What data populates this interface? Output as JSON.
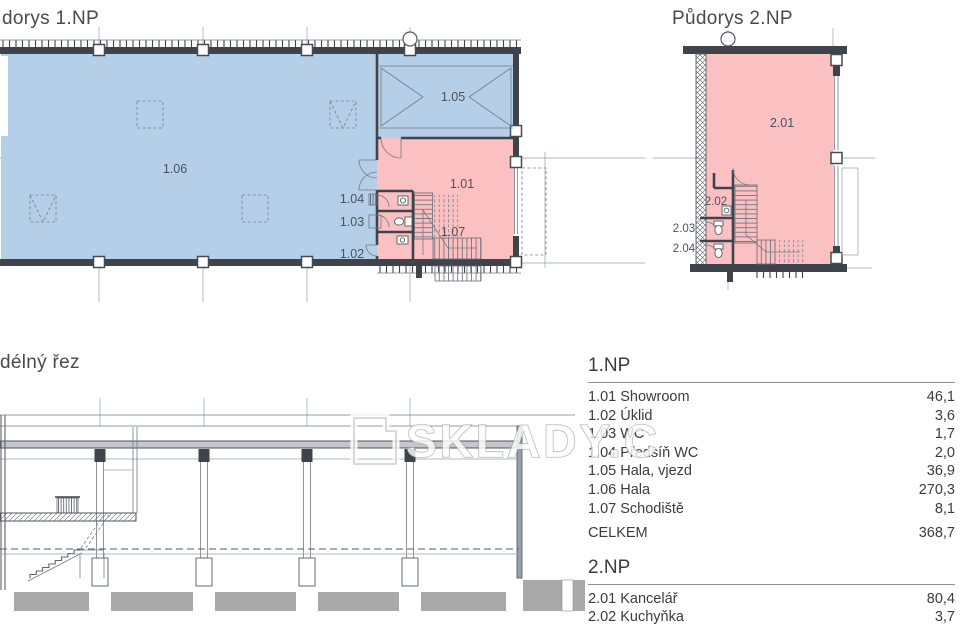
{
  "plans": {
    "plan1": {
      "title": "dorys 1.NP",
      "rooms": {
        "r101": "1.01",
        "r102": "1.02",
        "r103": "1.03",
        "r104": "1.04",
        "r105": "1.05",
        "r106": "1.06",
        "r107": "1.07"
      }
    },
    "plan2": {
      "title": "Půdorys 2.NP",
      "rooms": {
        "r201": "2.01",
        "r202": "2.02",
        "r203": "2.03",
        "r204": "2.04"
      }
    },
    "section": {
      "title": "délný řez"
    }
  },
  "watermark": {
    "text": "SKLADY.C"
  },
  "colors": {
    "hala_fill": "#b5cfe8",
    "office_fill": "#fbc0c1",
    "wall": "#3f444c"
  },
  "legend": {
    "floor1": {
      "heading": "1.NP",
      "rows": [
        {
          "label": "1.01 Showroom",
          "value": "46,1"
        },
        {
          "label": "1.02 Úklid",
          "value": "3,6"
        },
        {
          "label": "1.03 WC",
          "value": "1,7"
        },
        {
          "label": "1.04 Předsíň WC",
          "value": "2,0"
        },
        {
          "label": "1.05 Hala, vjezd",
          "value": "36,9"
        },
        {
          "label": "1.06 Hala",
          "value": "270,3"
        },
        {
          "label": "1.07 Schodiště",
          "value": "8,1"
        }
      ],
      "total_label": "CELKEM",
      "total_value": "368,7"
    },
    "floor2": {
      "heading": "2.NP",
      "rows": [
        {
          "label": "2.01 Kancelář",
          "value": "80,4"
        },
        {
          "label": "2.02 Kuchyňka",
          "value": "3,7"
        }
      ]
    }
  }
}
